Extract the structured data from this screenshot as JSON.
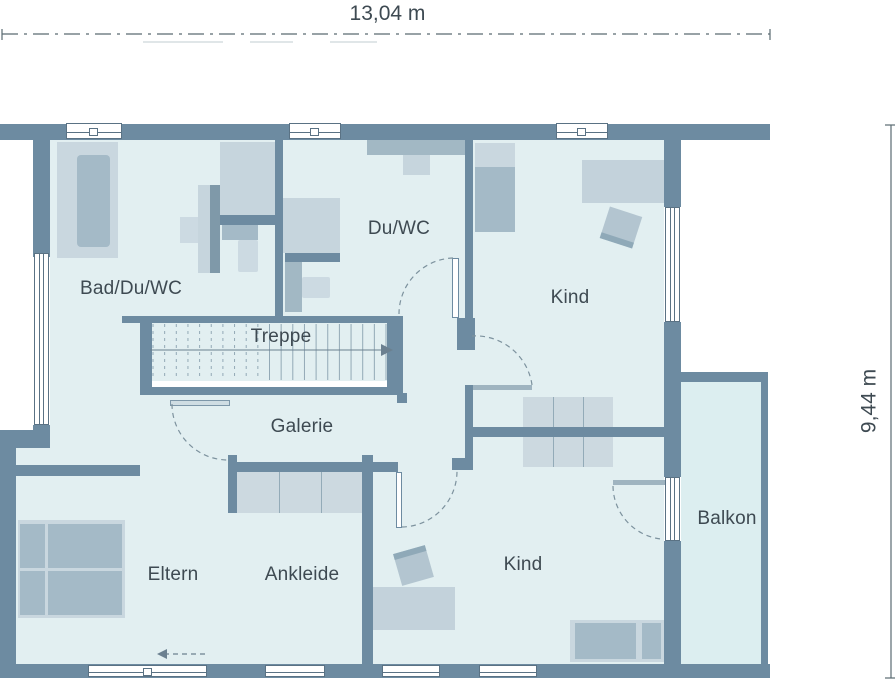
{
  "title": "Obergeschoss Grundriss",
  "dimension_labels": {
    "width": "13,04 m",
    "height": "9,44 m"
  },
  "rooms": {
    "bad": {
      "label": "Bad/Du/WC"
    },
    "duwc": {
      "label": "Du/WC"
    },
    "kind_top": {
      "label": "Kind"
    },
    "treppe": {
      "label": "Treppe"
    },
    "galerie": {
      "label": "Galerie"
    },
    "eltern": {
      "label": "Eltern"
    },
    "ankleide": {
      "label": "Ankleide"
    },
    "kind_bottom": {
      "label": "Kind"
    },
    "balkon": {
      "label": "Balkon"
    }
  },
  "colors": {
    "wall": "#6d8ba1",
    "floor": "#e2eff1",
    "balcony_floor": "#dceef0",
    "text": "#3e4a52",
    "dimension": "#5a6a72"
  }
}
